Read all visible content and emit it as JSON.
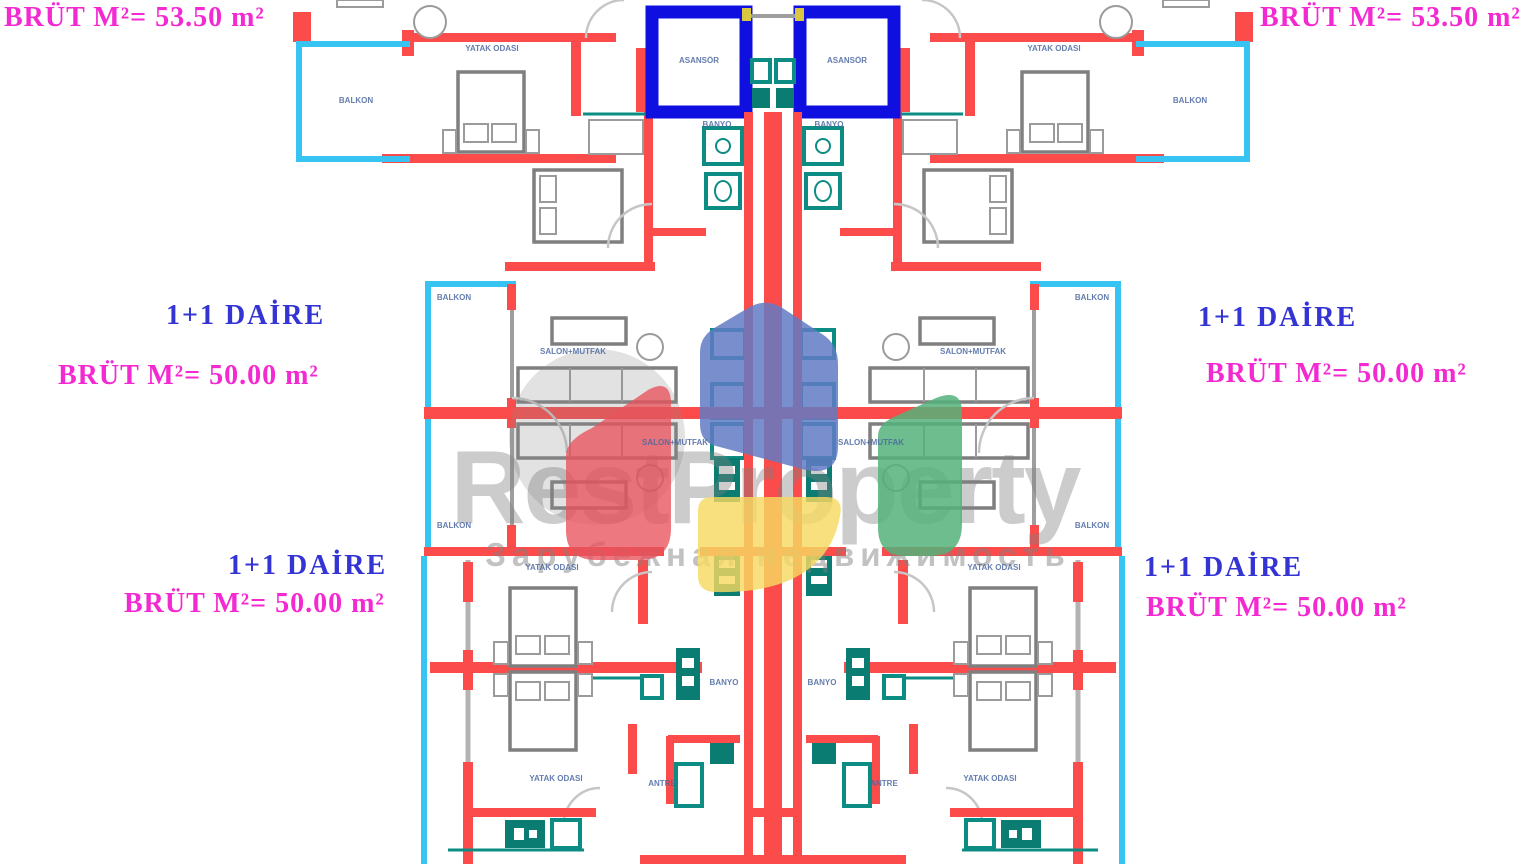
{
  "plan": {
    "kind": "residential apartment floor plan, mirrored left-right",
    "unit_labels": {
      "top_left": {
        "area": "BRÜT M²= 53.50 m²"
      },
      "top_right": {
        "area": "BRÜT M²= 53.50 m²"
      },
      "mid_left": {
        "type": "1+1 DAİRE",
        "area": "BRÜT M²= 50.00 m²"
      },
      "mid_right": {
        "type": "1+1 DAİRE",
        "area": "BRÜT M²= 50.00 m²"
      },
      "bottom_left": {
        "type": "1+1 DAİRE",
        "area": "BRÜT M²= 50.00 m²"
      },
      "bottom_right": {
        "type": "1+1 DAİRE",
        "area": "BRÜT M²= 50.00 m²"
      }
    },
    "rooms": {
      "bedroom": "YATAK ODASI",
      "living_kitchen": "SALON+MUTFAK",
      "balcony": "BALKON",
      "bathroom": "BANYO",
      "hall": "ANTRE",
      "elevator": "ASANSÖR"
    },
    "colors": {
      "wall": "#fb4b4b",
      "balcony_line": "#38c4f2",
      "elevator": "#0f0fe0",
      "fixture": "#0d8c84",
      "unit_type_text": "#3434d4",
      "area_text": "#f32ad2"
    }
  },
  "watermark": {
    "brand": "RestProperty",
    "tagline": "Зарубежная недвижимость",
    "logo_colors": {
      "roof": "#627ac4",
      "left": "#e8525c",
      "right": "#54b27a",
      "bottom": "#f7d962"
    }
  }
}
